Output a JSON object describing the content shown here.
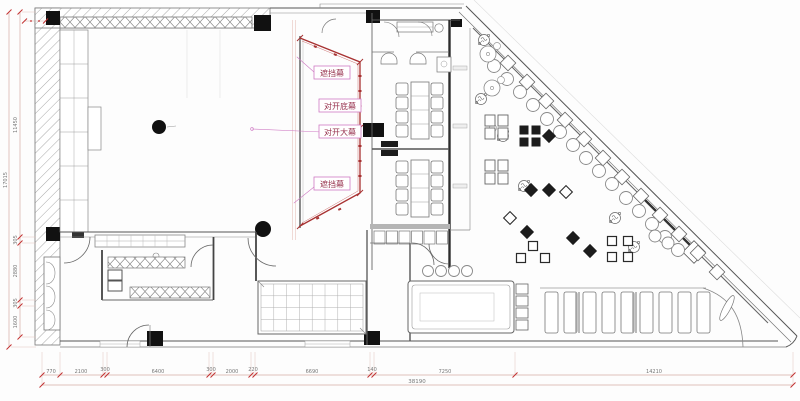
{
  "drawing_title": "restaurant-theatre-floor-plan",
  "curtain_labels": {
    "top": "遮挡幕",
    "split_bottom": "对开底幕",
    "split_main": "对开大幕",
    "lower": "遮挡幕"
  },
  "dimensions": {
    "bottom": [
      "770",
      "2100",
      "300",
      "6400",
      "300",
      "2000",
      "220",
      "6690",
      "140",
      "7250",
      "14210"
    ],
    "bottom_total": "38190",
    "left": [
      "11450",
      "17015",
      "305",
      "2880",
      "305",
      "1600"
    ]
  },
  "colors": {
    "wall": "#4a4a4a",
    "curtain_red": "#a83232",
    "label_box_magenta": "#cf7ac4",
    "label_text": "#97314d",
    "dim_line": "#d4aca3",
    "dim_tick": "#c23030",
    "dim_text": "#777777"
  }
}
